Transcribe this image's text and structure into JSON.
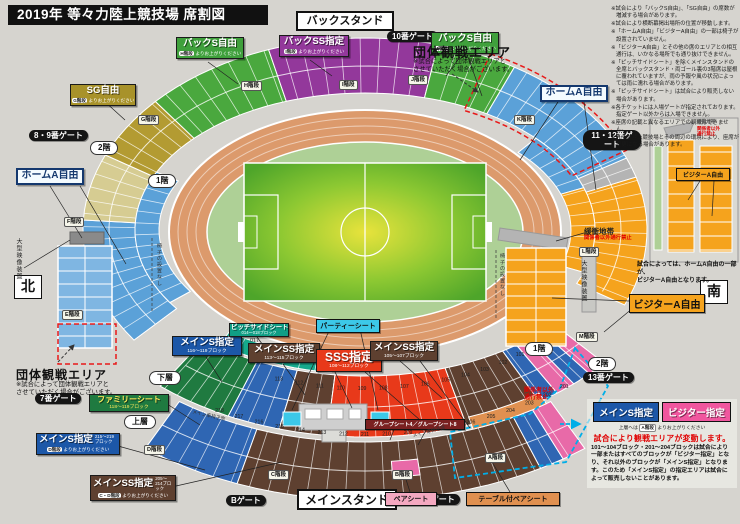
{
  "title": "2019年 等々力陸上競技場 席割図",
  "stand_names": {
    "back": "バックスタンド",
    "main": "メインスタンド"
  },
  "compass": {
    "north": "北",
    "south": "南"
  },
  "stair_suffix": "よりお上がりください",
  "gates": {
    "g7": "7番ゲート",
    "g89": "8・9番ゲート",
    "g10": "10番ゲート",
    "g1112": "11・12番ゲート",
    "g13": "13番ゲート",
    "ga": "Aゲート",
    "gb": "Bゲート"
  },
  "floors": {
    "f1l": "1階",
    "f2l": "2階",
    "f1r": "1階",
    "f2r": "2階",
    "lower": "下層",
    "upper": "上層"
  },
  "stairs": {
    "a": "A階段",
    "b": "B階段",
    "c": "C階段",
    "d": "D階段",
    "e": "E階段",
    "f": "F階段",
    "g": "G階段",
    "h": "H階段",
    "i": "I階段",
    "j": "J階段",
    "k": "K階段",
    "l": "L階段",
    "m": "M階段"
  },
  "sections": {
    "sg": {
      "name": "SG自由",
      "stairs": "G階段",
      "color": "#a8922a"
    },
    "backs_left": {
      "name": "バックS自由",
      "stairs": "H階段",
      "color": "#3fa03c"
    },
    "backss": {
      "name": "バックSS指定",
      "stairs": "I階段",
      "color": "#93389b"
    },
    "backs_right": {
      "name": "バックS自由",
      "stairs": "J階段",
      "color": "#3fa03c"
    },
    "homea_left": {
      "name": "ホームA自由",
      "color": "#5ba1d8"
    },
    "homea_right": {
      "name": "ホームA自由",
      "color": "#5ba1d8"
    },
    "visitora": {
      "name": "ビジターA自由",
      "color": "#f5a31d"
    },
    "mains_lower": {
      "name": "メインS指定",
      "blocks": "116～119ブロック",
      "color": "#1c57a8"
    },
    "pitchside": {
      "name": "ピッチサイドシート",
      "blocks": "014～018ブロック",
      "color": "#109e85"
    },
    "party": {
      "name": "パーティーシート",
      "color": "#3cc8e8"
    },
    "mainss_113": {
      "name": "メインSS指定",
      "blocks": "113～115ブロック",
      "color": "#5e4030"
    },
    "sss": {
      "name": "SSS指定",
      "blocks": "108～112ブロック",
      "color": "#e8391a"
    },
    "mainss_105": {
      "name": "メインSS指定",
      "blocks": "105～107ブロック",
      "color": "#5e4030"
    },
    "mains_upper": {
      "name": "メインS指定",
      "blocks": "215～219ブロック",
      "stairs": "D階段",
      "color": "#1c57a8"
    },
    "mainss_upper": {
      "name": "メインSS指定",
      "blocks": "205～214ブロック",
      "stairs": "C・D階段",
      "color": "#5e4030"
    },
    "family": {
      "name": "ファミリーシート",
      "blocks": "118～119ブロック",
      "color": "#1f7a40"
    },
    "pair": {
      "name": "ペアシート",
      "color": "#f4a8c0"
    },
    "tablepair": {
      "name": "テーブル付ペアシート",
      "color": "#e09050"
    },
    "group": {
      "name": "グループシート4／グループシート8"
    }
  },
  "group_area": {
    "title": "団体観戦エリア",
    "note1": "※試合によって団体観戦エリアと",
    "note2": "させていただく場合がございます。"
  },
  "buffer": {
    "label": "緩衝地帯",
    "warn": "関係者以外通行禁止"
  },
  "no_pass": {
    "line1": "関係者以外",
    "line2": "通行禁止"
  },
  "annotations": {
    "screen": "大型映像装置",
    "no_chair": "椅子の設置なし",
    "wheelchair": "メイン車椅子席"
  },
  "variable_box": {
    "mains": "メインS指定",
    "visitor": "ビジター指定",
    "stair_pre": "上層へは",
    "stair": "A階段",
    "stair_post": "よりお上がりください",
    "headline": "試合により観戦エリアが変動します。",
    "body": "101～104ブロック・201～204ブロックは試合により一部またはすべてのブロックが「ビジター指定」となり、それ以外のブロックが「メインS指定」となります。このため「メインS指定」の指定エリアは試合によって販売しないことがあります。"
  },
  "inset": {
    "visitor_label": "ビジターA自由",
    "buffer": "緩衝地帯",
    "warn1": "関係者以外",
    "warn2": "通行禁止",
    "note1": "試合によっては、ホームA自由の一部が、",
    "note2": "ビジターA自由となります。"
  },
  "notes": [
    "※試合により「バックS自由」、「SG自由」の席数が増減する場合があります。",
    "※試合により横断幕掲出場所の位置が移動します。",
    "※「ホームA自由」「ビジターA自由」の一部は椅子が設置されていません。",
    "※「ビジターA自由」とその他の席のエリアとの相互通行は、いかなる場所でも通り抜けできません。",
    "※「ピッチサイドシート」を除くメインスタンドの全席とバックスタンド・両ゴール裏の3階席は屋根に覆われていますが、雨の予報や風の状況によっては雨に濡れる場合があります。",
    "※「ピッチサイドシート」は試合により販売しない場合があります。",
    "※各チケットには入場ゲートが指定されております。指定ゲート以外からは入場できません。",
    "※座席の記載と異なるエリアでの観戦はできません。",
    "※等々力陸上競技場とその周辺の環境により、座席が変更になる場合があります。"
  ],
  "block_numbers": {
    "lower": [
      "113",
      "112",
      "111",
      "110",
      "109",
      "108",
      "107",
      "106",
      "105",
      "104",
      "103",
      "102",
      "101"
    ],
    "upper": [
      "218",
      "217",
      "216",
      "215",
      "214",
      "213",
      "212",
      "211",
      "210",
      "209",
      "208",
      "207",
      "206",
      "205",
      "204",
      "203",
      "202",
      "201"
    ],
    "pitchside": [
      "018",
      "017",
      "016",
      "015",
      "014"
    ]
  },
  "palette": {
    "green": "#4aa83e",
    "purple": "#93389b",
    "gold": "#b39b32",
    "tan": "#d6cc92",
    "homeBlue": "#5ba1d8",
    "orange": "#f5a31d",
    "buffer": "#b4b4b4",
    "familyGreen": "#1f7a40",
    "mainsBlue": "#2f66b3",
    "ssBrown": "#5e4030",
    "sssRed": "#e8391a",
    "visitorPink": "#e86aa8",
    "pitchTeal": "#16a98c",
    "partyCyan": "#3cc8e8",
    "tableOrange": "#e09050",
    "trackSalmon": "#dc9a6c",
    "apron": "#aed096",
    "background": "#d6d4cf",
    "redDash": "#e81818",
    "cyanDash": "#00aee8"
  }
}
